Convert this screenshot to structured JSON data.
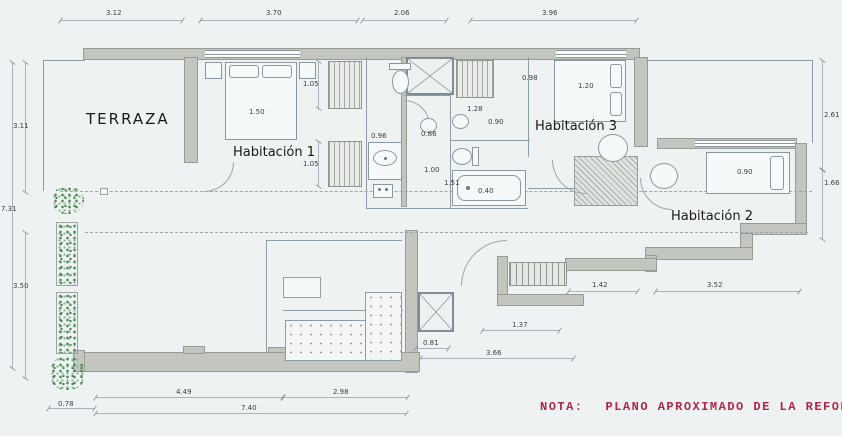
{
  "rooms": {
    "terraza": "TERRAZA",
    "hab1": "Habitación 1",
    "hab2": "Habitación 2",
    "hab3": "Habitación 3"
  },
  "note": {
    "label": "NOTA:",
    "text": "PLANO APROXIMADO DE LA REFORMA FINAL"
  },
  "dims": {
    "d_top1": "3.12",
    "d_top2": "3.70",
    "d_top3": "2.06",
    "d_top4": "3.96",
    "d_left1": "3.11",
    "d_left2": "7.31",
    "d_left3": "3.50",
    "d_right1": "2.61",
    "d_right2": "1.66",
    "d_bot1": "0.78",
    "d_bot2": "4.49",
    "d_bot3": "2.98",
    "d_bot4": "7.40",
    "d_hall1": "0.81",
    "d_hall2": "3.66",
    "d_hall3": "1.37",
    "d_h2a": "1.42",
    "d_h2b": "3.52",
    "d_bed1": "1.50",
    "d_bed2": "0.90",
    "d_bed3": "1.20",
    "d_c1": "1.05",
    "d_c2": "1.05",
    "d_c3": "0.96",
    "d_c4": "0.98",
    "d_b1": "1.28",
    "d_b2": "0.90",
    "d_b3": "0.86",
    "d_b4": "1.00",
    "d_b5": "1.51",
    "d_b6": "0.40"
  },
  "colors": {
    "background": "#eff2f2",
    "wall_fill": "#c2c6bf",
    "drawing_line": "#8f9ca4",
    "plant_green": "#4f8f5c",
    "note_red": "#b22448"
  }
}
